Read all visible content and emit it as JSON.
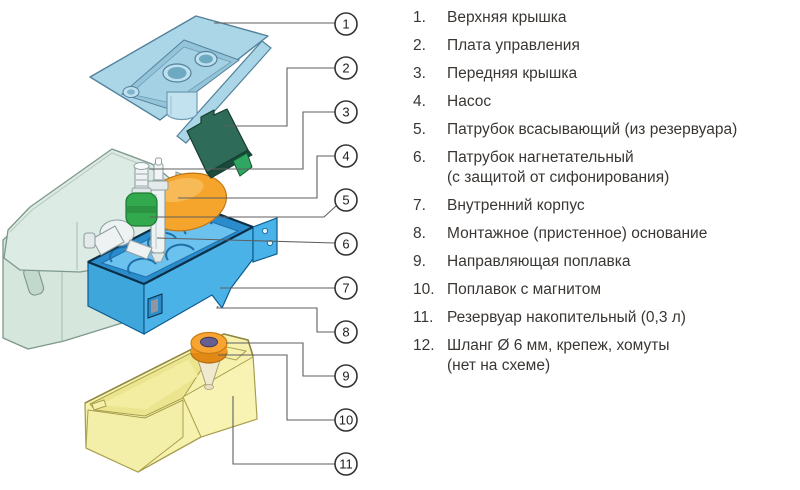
{
  "legend": {
    "items": [
      {
        "num": "1.",
        "label": "Верхняя крышка"
      },
      {
        "num": "2.",
        "label": "Плата управления"
      },
      {
        "num": "3.",
        "label": "Передняя крышка"
      },
      {
        "num": "4.",
        "label": "Насос"
      },
      {
        "num": "5.",
        "label": "Патрубок всасывающий (из резервуара)"
      },
      {
        "num": "6.",
        "label": "Патрубок нагнетательный\n(с защитой от сифонирования)"
      },
      {
        "num": "7.",
        "label": "Внутренний корпус"
      },
      {
        "num": "8.",
        "label": "Монтажное (пристенное) основание"
      },
      {
        "num": "9.",
        "label": "Направляющая поплавка"
      },
      {
        "num": "10.",
        "label": "Поплавок с магнитом"
      },
      {
        "num": "11.",
        "label": "Резервуар накопительный (0,3 л)"
      },
      {
        "num": "12.",
        "label": "Шланг Ø 6 мм, крепеж, хомуты\n(нет на схеме)"
      }
    ]
  },
  "callouts": {
    "labels": [
      "1",
      "2",
      "3",
      "4",
      "5",
      "6",
      "7",
      "8",
      "9",
      "10",
      "11"
    ]
  },
  "diagram": {
    "parts": {
      "top_cover": {
        "name": "Верхняя крышка",
        "color": "#abd6e8"
      },
      "control_board": {
        "name": "Плата управления",
        "color": "#2e6b58"
      },
      "front_cover": {
        "name": "Передняя крышка",
        "color": "#dcebe3"
      },
      "pump": {
        "name": "Насос",
        "color": "#f5a42c"
      },
      "suction_pipe": {
        "name": "Патрубок всасывающий",
        "color": "#33a94d"
      },
      "discharge_pipe": {
        "name": "Патрубок нагнетательный",
        "color": "#eef2f2"
      },
      "inner_body": {
        "name": "Внутренний корпус",
        "color": "#4bb2e8"
      },
      "mounting_base": {
        "name": "Монтажное основание",
        "color": "#d5e6dd"
      },
      "float_guide": {
        "name": "Направляющая поплавка",
        "color": "#efe9cf"
      },
      "float": {
        "name": "Поплавок с магнитом",
        "color": "#f7a432"
      },
      "reservoir": {
        "name": "Резервуар накопительный",
        "color": "#f6f1ac"
      }
    }
  }
}
